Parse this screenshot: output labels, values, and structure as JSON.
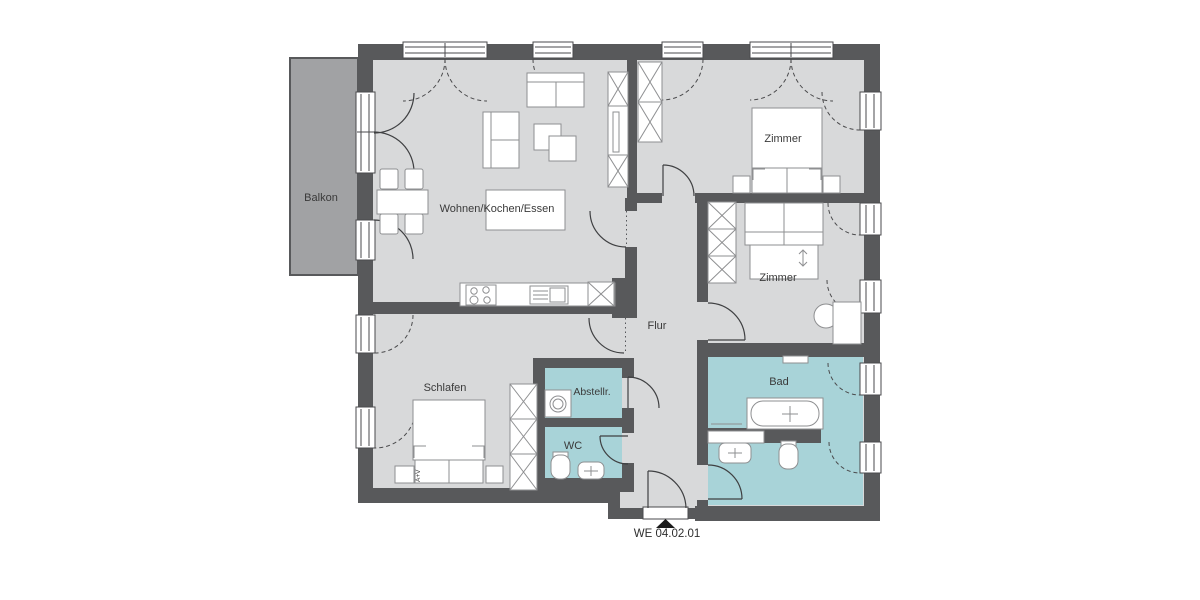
{
  "plan": {
    "unit_label": "WE 04.02.01",
    "rooms": [
      {
        "id": "balkon",
        "label": "Balkon"
      },
      {
        "id": "wohnen",
        "label": "Wohnen/Kochen/Essen"
      },
      {
        "id": "zimmer-1",
        "label": "Zimmer"
      },
      {
        "id": "zimmer-2",
        "label": "Zimmer"
      },
      {
        "id": "flur",
        "label": "Flur"
      },
      {
        "id": "schlafen",
        "label": "Schlafen"
      },
      {
        "id": "abstellraum",
        "label": "Abstellr."
      },
      {
        "id": "wc",
        "label": "WC"
      },
      {
        "id": "bad",
        "label": "Bad"
      }
    ],
    "bed_annotation": "A+V",
    "colors": {
      "wall": "#58595b",
      "floor": "#d8d9da",
      "wet_room": "#a8d3d8",
      "balcony": "#a1a2a4",
      "furniture_line": "#8e8f91",
      "door_line": "#3f4042",
      "text": "#3a3a3a",
      "marker": "#1a1a1a"
    }
  }
}
